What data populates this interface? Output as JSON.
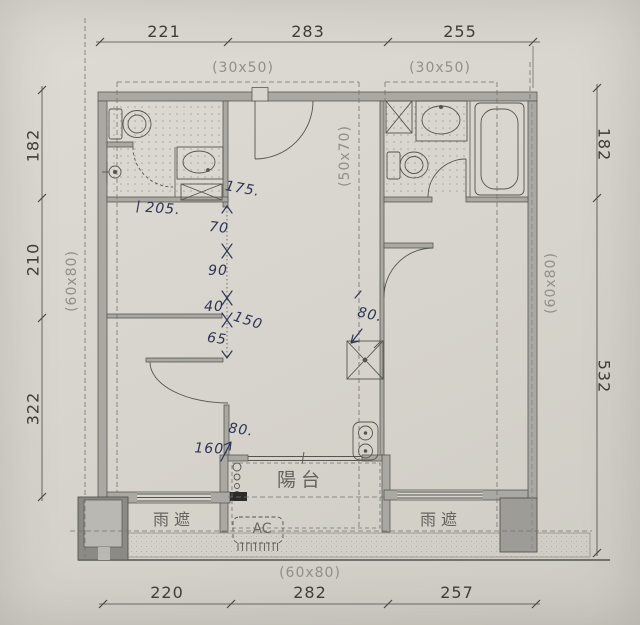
{
  "drawing_type": "apartment floor plan",
  "dims": {
    "top": [
      "221",
      "283",
      "255"
    ],
    "top_specs": [
      "(30x50)",
      "(30x50)"
    ],
    "left": [
      "182",
      "210",
      "322"
    ],
    "left_spec": "(60x80)",
    "right": [
      "182",
      "532"
    ],
    "right_spec": "(60x80)",
    "bottom": [
      "220",
      "282",
      "257"
    ],
    "bottom_spec": "(60x80)",
    "interior_spec": "(50x70)"
  },
  "labels": {
    "balcony": "陽台",
    "rain_cover_left": "雨遮",
    "rain_cover_right": "雨遮",
    "ac_unit": "AC"
  },
  "handwritten": {
    "bath_175": "175.",
    "bath_205": "205.",
    "seg_70": "70",
    "seg_90": "90",
    "seg_40": "40",
    "seg_150": "150",
    "seg_65": "65",
    "kitchen_80": "80.",
    "balcony_160": "160.",
    "balcony_80": "80."
  },
  "colors": {
    "paper": "#d8d5ce",
    "wall_fill": "#a9a8a2",
    "line": "#55544f",
    "dim_text": "#3e3d38",
    "grey_label": "#908f88",
    "handwriting_ink": "#2e3454",
    "dashed_line": "#74736d"
  }
}
